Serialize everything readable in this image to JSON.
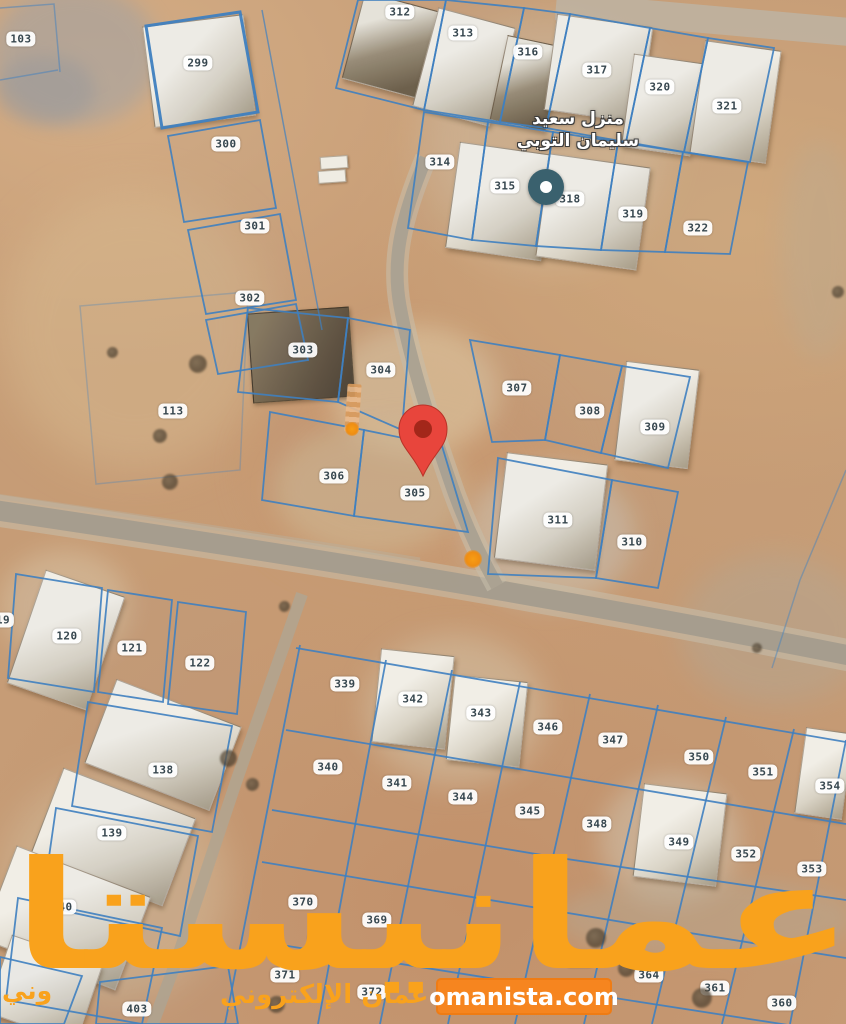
{
  "map": {
    "type": "satellite-parcel-map",
    "poi": {
      "label_line1": "منزل سعيد",
      "label_line2": "سليمان التوبي",
      "circle_color": "#3a616e",
      "x": 546,
      "y": 187
    },
    "pin": {
      "x": 423,
      "y": 474,
      "color": "#e8453c",
      "inner_color": "#a3271a",
      "plot": "305"
    },
    "parcel_line_color": "#3f80c0",
    "plots": [
      {
        "label": "103",
        "x": 21,
        "y": 39
      },
      {
        "label": "299",
        "x": 198,
        "y": 63
      },
      {
        "label": "300",
        "x": 226,
        "y": 144
      },
      {
        "label": "301",
        "x": 255,
        "y": 226
      },
      {
        "label": "302",
        "x": 250,
        "y": 298
      },
      {
        "label": "312",
        "x": 400,
        "y": 12
      },
      {
        "label": "313",
        "x": 463,
        "y": 33
      },
      {
        "label": "316",
        "x": 528,
        "y": 52
      },
      {
        "label": "317",
        "x": 597,
        "y": 70
      },
      {
        "label": "320",
        "x": 660,
        "y": 87
      },
      {
        "label": "321",
        "x": 727,
        "y": 106
      },
      {
        "label": "314",
        "x": 440,
        "y": 162
      },
      {
        "label": "315",
        "x": 505,
        "y": 186
      },
      {
        "label": "318",
        "x": 570,
        "y": 199
      },
      {
        "label": "319",
        "x": 633,
        "y": 214
      },
      {
        "label": "322",
        "x": 698,
        "y": 228
      },
      {
        "label": "303",
        "x": 303,
        "y": 350
      },
      {
        "label": "304",
        "x": 381,
        "y": 370
      },
      {
        "label": "113",
        "x": 173,
        "y": 411
      },
      {
        "label": "307",
        "x": 517,
        "y": 388
      },
      {
        "label": "308",
        "x": 590,
        "y": 411
      },
      {
        "label": "309",
        "x": 655,
        "y": 427
      },
      {
        "label": "306",
        "x": 334,
        "y": 476
      },
      {
        "label": "305",
        "x": 415,
        "y": 493
      },
      {
        "label": "311",
        "x": 558,
        "y": 520
      },
      {
        "label": "310",
        "x": 632,
        "y": 542
      },
      {
        "label": "19",
        "x": 3,
        "y": 620
      },
      {
        "label": "120",
        "x": 67,
        "y": 636
      },
      {
        "label": "121",
        "x": 132,
        "y": 648
      },
      {
        "label": "122",
        "x": 200,
        "y": 663
      },
      {
        "label": "138",
        "x": 163,
        "y": 770
      },
      {
        "label": "139",
        "x": 112,
        "y": 833
      },
      {
        "label": "140",
        "x": 62,
        "y": 907
      },
      {
        "label": "403",
        "x": 137,
        "y": 1009
      },
      {
        "label": "339",
        "x": 345,
        "y": 684
      },
      {
        "label": "342",
        "x": 413,
        "y": 699
      },
      {
        "label": "343",
        "x": 481,
        "y": 713
      },
      {
        "label": "346",
        "x": 548,
        "y": 727
      },
      {
        "label": "347",
        "x": 613,
        "y": 740
      },
      {
        "label": "350",
        "x": 699,
        "y": 757
      },
      {
        "label": "351",
        "x": 763,
        "y": 772
      },
      {
        "label": "354",
        "x": 830,
        "y": 786
      },
      {
        "label": "340",
        "x": 328,
        "y": 767
      },
      {
        "label": "341",
        "x": 397,
        "y": 783
      },
      {
        "label": "344",
        "x": 463,
        "y": 797
      },
      {
        "label": "345",
        "x": 530,
        "y": 811
      },
      {
        "label": "348",
        "x": 597,
        "y": 824
      },
      {
        "label": "349",
        "x": 679,
        "y": 842
      },
      {
        "label": "352",
        "x": 746,
        "y": 854
      },
      {
        "label": "353",
        "x": 812,
        "y": 869
      },
      {
        "label": "370",
        "x": 303,
        "y": 902
      },
      {
        "label": "369",
        "x": 377,
        "y": 920
      },
      {
        "label": "365",
        "x": 580,
        "y": 960
      },
      {
        "label": "371",
        "x": 285,
        "y": 975
      },
      {
        "label": "372",
        "x": 372,
        "y": 992
      },
      {
        "label": "364",
        "x": 649,
        "y": 975
      },
      {
        "label": "361",
        "x": 715,
        "y": 988
      },
      {
        "label": "360",
        "x": 782,
        "y": 1003
      }
    ]
  },
  "watermark": {
    "brand": "عمانيستا",
    "subtitle": "سوق عمان الإلكتروني",
    "fragment": "وني",
    "site": "omanista.com",
    "brand_color": "#f9a21c",
    "box_color": "#f6851f"
  }
}
